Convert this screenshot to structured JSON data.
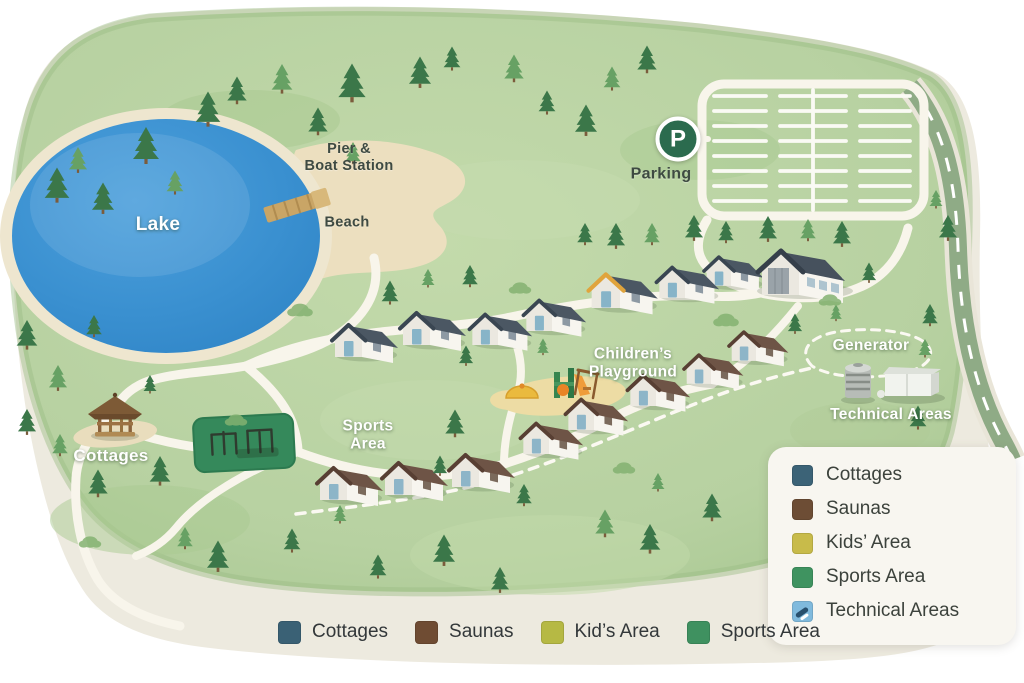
{
  "map_labels": {
    "lake": "Lake",
    "pier_line1": "Pier &",
    "pier_line2": "Boat Station",
    "beach": "Beach",
    "parking": "Parking",
    "parking_symbol": "P",
    "gazebo_area": "Cottages",
    "sports_line1": "Sports",
    "sports_line2": "Area",
    "playground_line1": "Children’s",
    "playground_line2": "Playground",
    "generator": "Generator",
    "technical_areas": "Technical Areas"
  },
  "legend_panel": {
    "items": [
      {
        "label": "Cottages",
        "color": "#3c6377",
        "icon": null
      },
      {
        "label": "Saunas",
        "color": "#6d4d35",
        "icon": null
      },
      {
        "label": "Kids’ Area",
        "color": "#c8bb4a",
        "icon": null
      },
      {
        "label": "Sports Area",
        "color": "#3f9360",
        "icon": null
      },
      {
        "label": "Technical Areas",
        "color": "#80badd",
        "icon": "tool-icon"
      }
    ]
  },
  "bottom_legend": {
    "items": [
      {
        "label": "Cottages",
        "color": "#3a6175"
      },
      {
        "label": "Saunas",
        "color": "#6f4c33"
      },
      {
        "label": "Kid’s Area",
        "color": "#b6b944"
      },
      {
        "label": "Sports Area",
        "color": "#3f9160"
      }
    ]
  },
  "colors": {
    "grass": "#b7d1a1",
    "paper": "#edeadf",
    "lake": "#3a90d0",
    "path": "#f8f5eb",
    "parking_badge": "#2b6b4e",
    "sports_field": "#35895b"
  }
}
